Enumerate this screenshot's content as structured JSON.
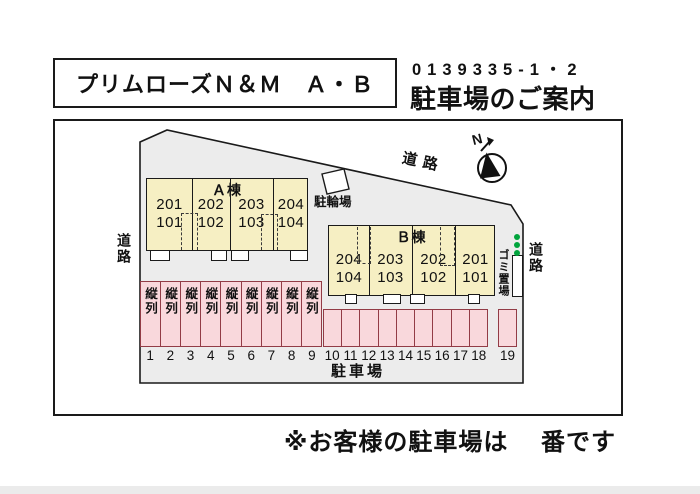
{
  "header": {
    "title": "プリムローズＮ＆Ｍ　Ａ・Ｂ",
    "code": "0139335-1・2",
    "subtitle": "駐車場のご案内"
  },
  "map": {
    "building_a": {
      "label": "Ａ棟",
      "units": [
        {
          "top": "201",
          "bottom": "101"
        },
        {
          "top": "202",
          "bottom": "102"
        },
        {
          "top": "203",
          "bottom": "103"
        },
        {
          "top": "204",
          "bottom": "104"
        }
      ]
    },
    "building_b": {
      "label": "Ｂ棟",
      "units": [
        {
          "top": "204",
          "bottom": "104"
        },
        {
          "top": "203",
          "bottom": "103"
        },
        {
          "top": "202",
          "bottom": "102"
        },
        {
          "top": "201",
          "bottom": "101"
        }
      ]
    },
    "labels": {
      "road_left": "道路",
      "road_top": "道路",
      "road_right": "道路",
      "bicycle_parking": "駐輪場",
      "garbage_area": "ゴミ置場",
      "parking_area": "駐車場",
      "north": "N"
    },
    "parking": {
      "tandem_label": "縦列",
      "left_numbers": [
        "1",
        "2",
        "3",
        "4",
        "5",
        "6",
        "7",
        "8",
        "9"
      ],
      "right_numbers": [
        "10",
        "11",
        "12",
        "13",
        "14",
        "15",
        "16",
        "17",
        "18"
      ],
      "detached_number": "19"
    }
  },
  "footer": {
    "note_prefix": "※お客様の駐車場は",
    "note_suffix": "番です"
  },
  "colors": {
    "building_fill": "#f6efc3",
    "parking_fill": "#f9d8dc",
    "parking_border": "#923c46",
    "site_fill": "#ececec",
    "green_dot": "#00a43c"
  }
}
